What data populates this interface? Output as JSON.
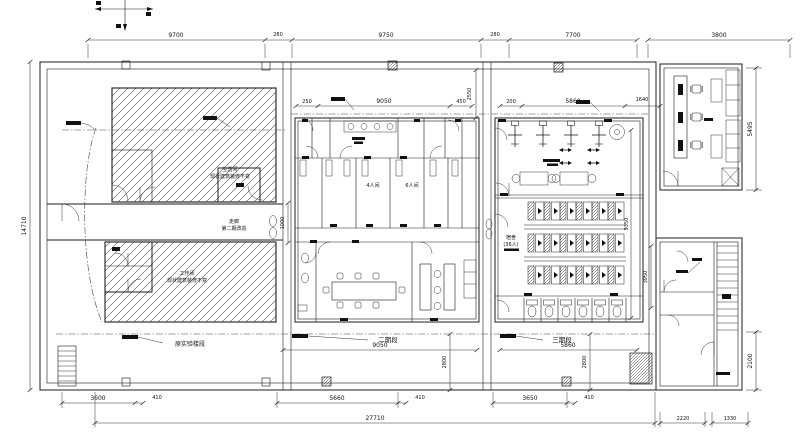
{
  "dims": {
    "top": [
      "9700",
      "280",
      "9750",
      "280",
      "7700",
      "3800"
    ],
    "upper_mid": [
      "250",
      "9050",
      "450"
    ],
    "v2550": "2550",
    "upper_right": [
      "200",
      "5860",
      "1640"
    ],
    "left_v": "14710",
    "v1000": "1000",
    "v9350": "9350",
    "v3050": "3050",
    "v5495": "5495",
    "v2100": "2100",
    "v2800a": "2800",
    "v2800b": "2800",
    "mid_width": "9050",
    "right_width": "5860",
    "bottom1": [
      "3600",
      "410",
      "5660",
      "410",
      "3650",
      "410"
    ],
    "bottom2": [
      "27710",
      "2220",
      "1330"
    ]
  },
  "labels": {
    "upper_left_room": [
      "生活间",
      "现状建筑装修不变"
    ],
    "corridor": [
      "走廊",
      "第二期改造"
    ],
    "lower_left_room": [
      "工作间",
      "现状建筑装修不变"
    ],
    "section_left": "原实验楼段",
    "section_mid": "二期段",
    "section_right": "三期段",
    "room_4p": "4人间",
    "room_6p": "6人间",
    "dorm": [
      "宿舍",
      "(36人)"
    ]
  },
  "icons": {
    "orientation_axis": "crosshair-arrows",
    "stairs": "stair-treads",
    "door": "quarter-arc-swing",
    "column": "hatched-square",
    "toilet": "wc-fixture",
    "sink": "cross-basin"
  },
  "colors": {
    "line": "#1c1c1c",
    "paper": "#ffffff",
    "hatch": "#555555"
  }
}
